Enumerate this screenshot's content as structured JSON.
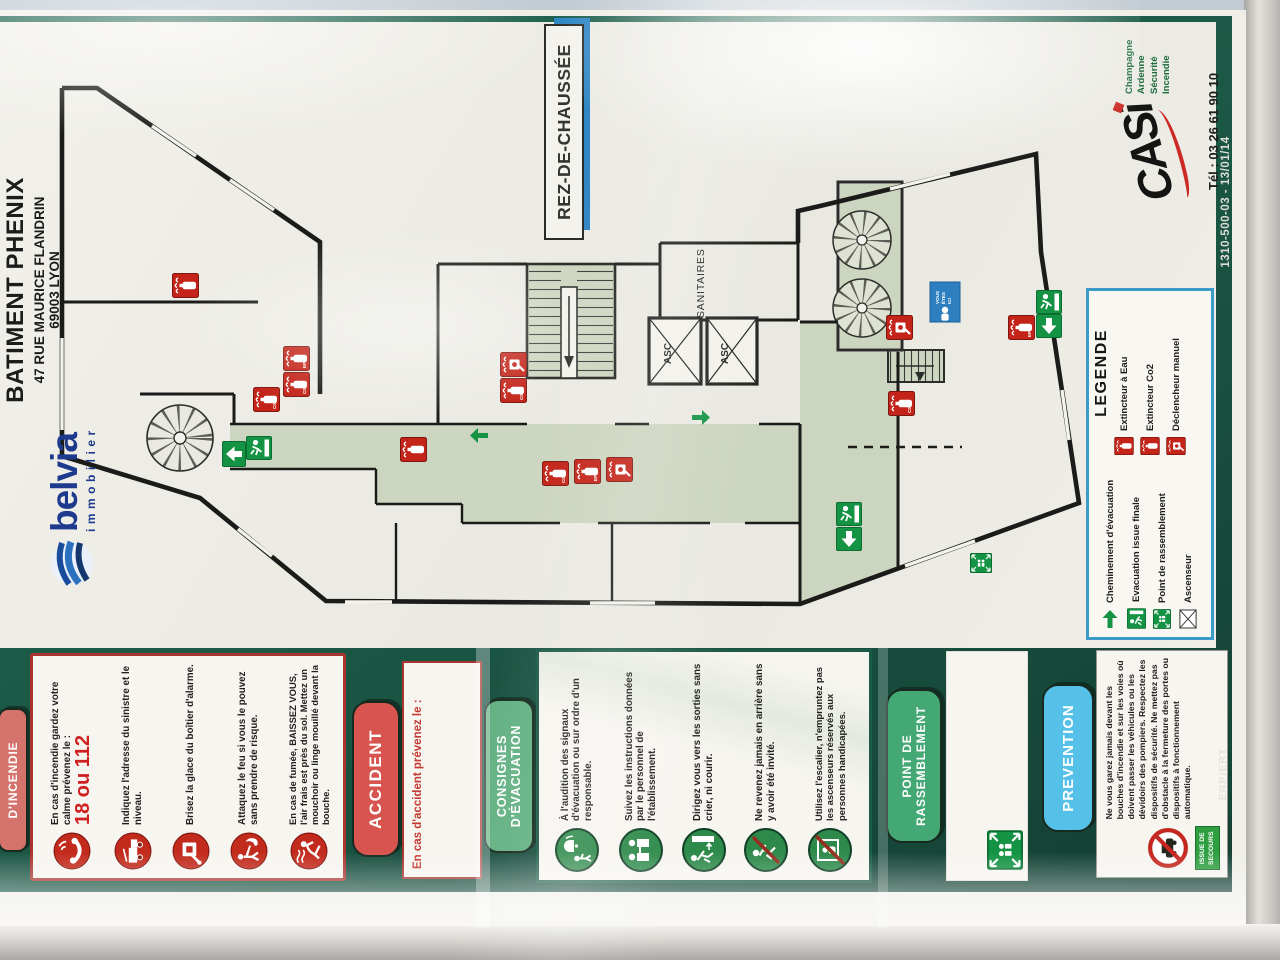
{
  "title": {
    "building": "BATIMENT PHENIX",
    "address": "47 RUE MAURICE FLANDRIN",
    "city": "69003 LYON"
  },
  "brand": {
    "name": "belvia",
    "tagline": "immobilier"
  },
  "floor_label": "REZ-DE-CHAUSSÉE",
  "maker": {
    "name": "CASi",
    "lines": [
      "Champagne Ardenne",
      "Sécurité",
      "Incendie"
    ],
    "phone": "Tél : 03 26 61 90 10",
    "serial": "1310-500-03 - 13/01/14"
  },
  "plan": {
    "sanitaires": "SANITAIRES",
    "asc": "ASC",
    "you_lines": [
      "VOUS",
      "ÊTES",
      "ICI"
    ],
    "ext_labels": [
      "EP",
      "C02"
    ]
  },
  "legend": {
    "title": "LEGENDE",
    "green": [
      "Cheminement d'évacuation",
      "Evacuation issue finale",
      "Point de rassemblement",
      "Ascenseur"
    ],
    "red": [
      "Extincteur à Eau",
      "Extincteur Co2",
      "Déclencheur manuel"
    ]
  },
  "panels": {
    "incendie": {
      "pill": "D'INCENDIE",
      "items": [
        {
          "icon": "phone-icon",
          "text": "En cas d'incendie gardez votre calme prévenez le :",
          "emphasis": "18 ou 112"
        },
        {
          "icon": "fire-truck-icon",
          "text": "Indiquez l'adresse du sinistre et le niveau."
        },
        {
          "icon": "alarm-box-icon",
          "text": "Brisez la glace du boîtier d'alarme."
        },
        {
          "icon": "fight-fire-icon",
          "text": "Attaquez le feu si vous le pouvez sans prendre de risque."
        },
        {
          "icon": "crouch-smoke-icon",
          "text": "En cas de fumée, BAISSEZ VOUS, l'air frais est près du sol. Mettez un mouchoir ou linge mouillé devant la bouche."
        }
      ]
    },
    "accident": {
      "pill": "ACCIDENT",
      "note": "En cas d'accident prévenez le :"
    },
    "consignes": {
      "pill_lines": [
        "CONSIGNES",
        "D'ÉVACUATION"
      ],
      "items": [
        {
          "icon": "alarm-signal-icon",
          "text": "À l'audition des signaux d'évacuation ou sur ordre d'un responsable."
        },
        {
          "icon": "staff-instructions-icon",
          "text": "Suivez les instructions données par le personnel de l'établissement."
        },
        {
          "icon": "walk-to-exit-icon",
          "text": "Dirigez vous vers les sorties sans crier, ni courir."
        },
        {
          "icon": "no-return-icon",
          "text": "Ne revenez jamais en arrière sans y avoir été invité."
        },
        {
          "icon": "no-elevator-icon",
          "text": "Utilisez l'escalier, n'empruntez pas les ascenseurs réservés aux personnes handicapées."
        }
      ]
    },
    "point": {
      "pill_lines": [
        "POINT DE",
        "RASSEMBLEMENT"
      ]
    },
    "prevention": {
      "pill": "PREVENTION",
      "text": "Ne vous garez jamais devant les bouches d'incendie et sur les voies où doivent passer les véhicules ou les dévidoirs des pompiers. Respectez les dispositifs de sécurité. Ne mettez pas d'obstacle à la fermeture des portes ou dispositifs à fonctionnement automatique.",
      "badge_lines": [
        "ISSUE DE",
        "SECOURS"
      ]
    }
  },
  "footer_code": "ERP/ERT",
  "colors": {
    "board_green": "#1c5a47",
    "corridor_green": "#ccd5bf",
    "exit_green": "#149344",
    "sign_red": "#c32318",
    "legend_blue": "#3d9bc9",
    "pill_salmon": "#d4726c",
    "pill_red": "#d8554f",
    "pill_green": "#63b183",
    "pill_point_green": "#43a874",
    "pill_cyan": "#55c1e9",
    "belvia_blue": "#1e3a8e",
    "casi_green": "#1c6b3c",
    "casi_red": "#cc2a24",
    "floor_blue": "#2e86c4"
  }
}
